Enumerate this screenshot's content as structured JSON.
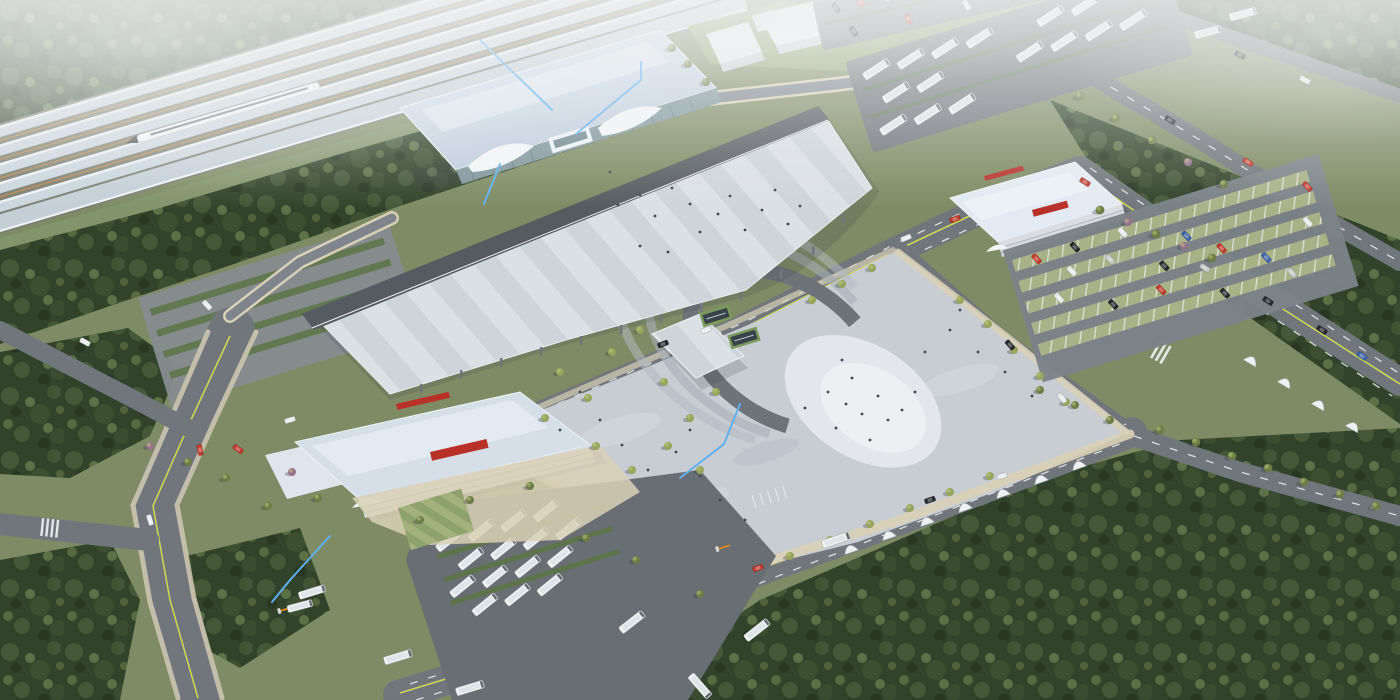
{
  "scene": {
    "type": "aerial-architectural-rendering",
    "subject": "high-speed-railway-station-complex",
    "landmarks": [
      "railway-platforms-with-train",
      "main-terminal-building",
      "elevated-deck-canopy",
      "pedestrian-plaza-with-horseshoe-feature",
      "bus-terminal-building",
      "transport-center-building",
      "bus-parking-yards",
      "car-parking-lots",
      "road-network",
      "surrounding-forest"
    ]
  },
  "colors": {
    "ground": "#7e8b64",
    "grass": "#83936a",
    "lawn": "#8fa26d",
    "lawnLight": "#a3b27c",
    "forest1": "#31432a",
    "forest2": "#45593a",
    "forest3": "#5d7147",
    "road": "#71767c",
    "roadDark": "#585d63",
    "band": "#565b61",
    "yard": "#696e74",
    "plaza": "#c8cdd3",
    "plazaLight": "#dadfe4",
    "cream": "#d9d0b6",
    "deckA": "#dbe0e5",
    "deckB": "#cdd4da",
    "stationRoof": "#c2cedf",
    "stationRoofHi": "#dde6ef",
    "canopy": "#cdd6df",
    "glass": "#7e959b",
    "glassDark": "#55666e",
    "trackBed": "#7b8072",
    "trackTie": "#bc8752",
    "white": "#f3f5f7",
    "boxWhite": "#e9edf0",
    "signRed": "#b73129",
    "hedge": "#5c7446",
    "stall": "#a9b287",
    "treeA": "#97a45e",
    "treeB": "#6d7d48",
    "ptree": "#96718d",
    "laneYellow": "#cdd655",
    "laneWhite": "#eef1f3",
    "blueLine": "#5eb0f0",
    "busBody": "#f1f3f5",
    "person": "#40464d",
    "steel": "#9aa2aa",
    "ringGray": "#6d7378",
    "barrier": "#e2891f",
    "carRed": "#c0392b",
    "carBlue": "#3a63a8",
    "carBlack": "#23282d",
    "carWhite": "#e8eaec",
    "carSilver": "#c6cacd"
  },
  "annotations": {
    "leader_line_color": "#5eb0f0",
    "leader_line_count": 5
  },
  "signage": {
    "color": "#b73129"
  },
  "vehicles": {
    "trains": 1,
    "parked_buses_approx": 38,
    "cars_approx": 55
  }
}
